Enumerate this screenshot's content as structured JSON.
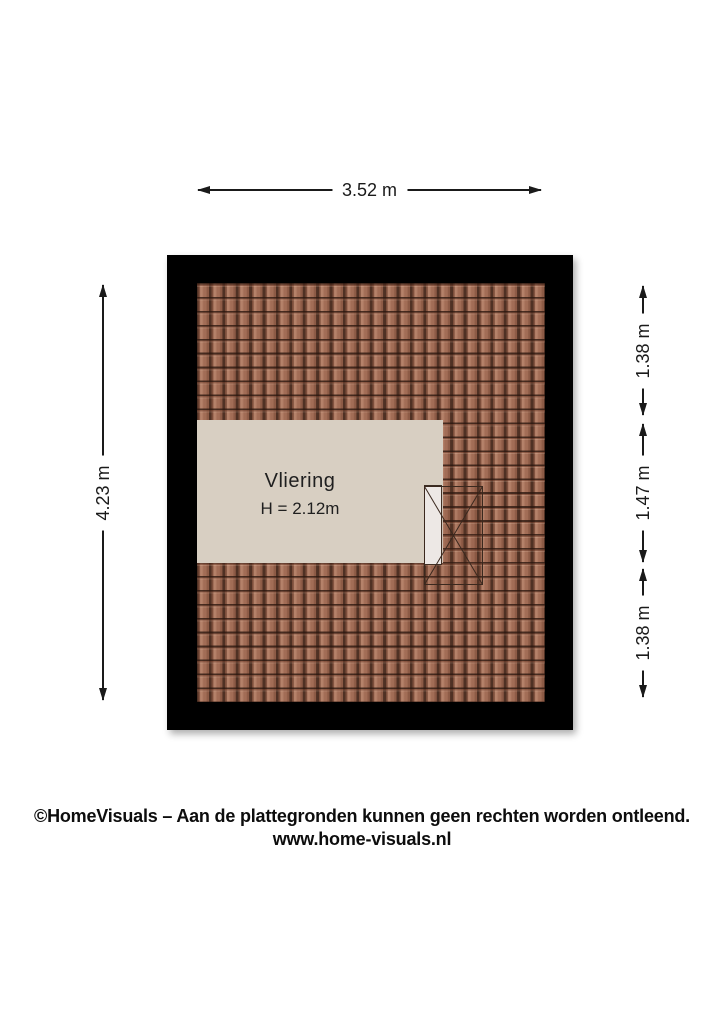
{
  "floorplan": {
    "room": {
      "label": "Vliering",
      "ceiling_height": "H = 2.12m"
    },
    "dimensions": {
      "width_top": "3.52 m",
      "height_left": "4.23 m",
      "right_segments": [
        "1.38 m",
        "1.47 m",
        "1.38 m"
      ]
    }
  },
  "footer": {
    "copyright": "©HomeVisuals – Aan de plattegronden kunnen geen rechten worden ontleend.",
    "website": "www.home-visuals.nl"
  },
  "theme": {
    "background": "#ffffff",
    "wall_color": "#000000",
    "room_floor_color": "#d8cfc2",
    "tile_base": "#a26d56",
    "tile_light": "#b5826a",
    "tile_dark": "#4f3124",
    "dimension_color": "#1a1a1a"
  }
}
